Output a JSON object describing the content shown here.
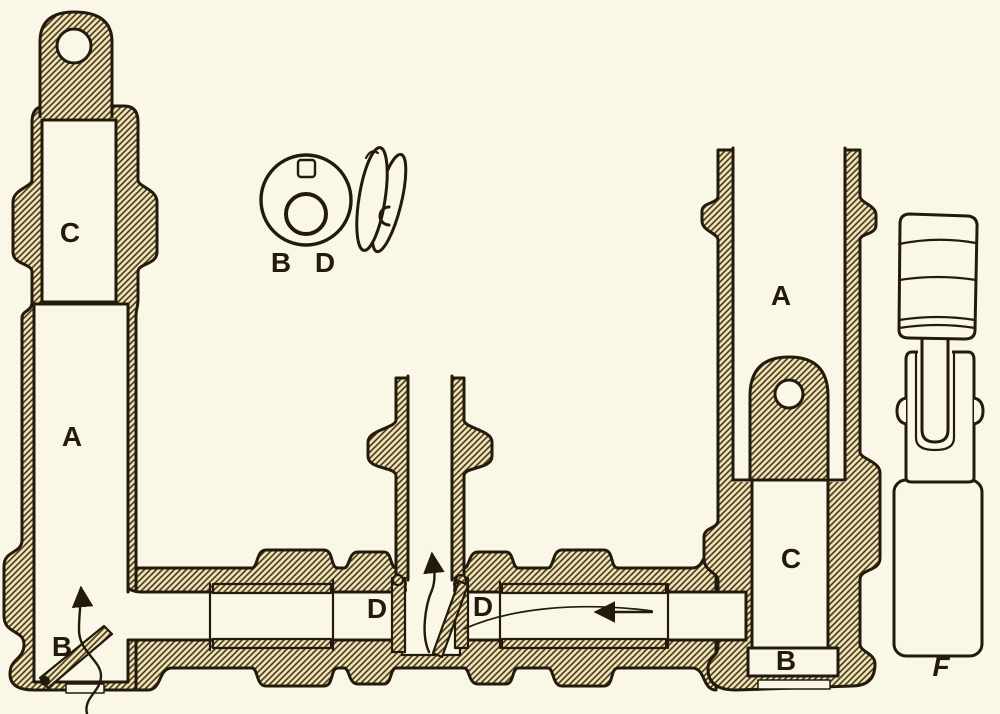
{
  "colors": {
    "paper": "#fbf7e6",
    "ink": "#221a0c",
    "hatch-line": "#4a3b15",
    "hatch-bg": "#ece1ba"
  },
  "labels": {
    "left_bore_upper": "C",
    "left_bore_main": "A",
    "left_inlet": "B",
    "disc_face": "B D",
    "tee_sleeve_left": "D",
    "tee_sleeve_right": "D",
    "right_bore_main": "A",
    "right_bore_lower": "C",
    "right_cap": "B",
    "fitting_side_view": "F"
  }
}
